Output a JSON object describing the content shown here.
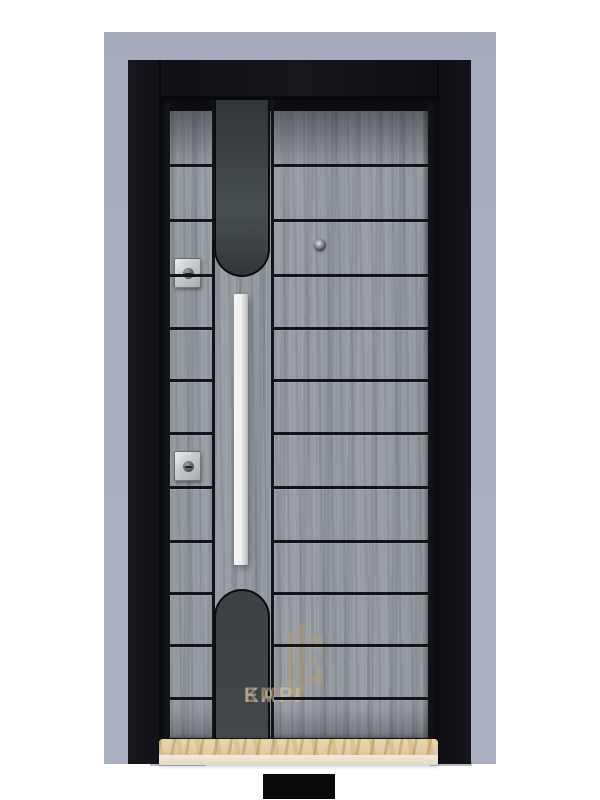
{
  "meta": {
    "description": "Product photo of a grey wood-grain steel security door with black frame, long white vertical pull handle, two cylinder locks, peephole and marble threshold"
  },
  "colors": {
    "background": "#ffffff",
    "wall": "#a8aebf",
    "frame": "#15161b",
    "wood": "#979da3",
    "groove": "#121419",
    "insert": "#3d4347",
    "insert_border": "#0b0c0f",
    "handle": "#ecedec",
    "steel": "#a8acaf",
    "marble": "#e6d3ae",
    "marble_front": "#f2ead7",
    "watermark_gold": "#c8a35b",
    "watermark_silver": "#ccd1d7",
    "shadow": "#7e838d",
    "footer_black": "#0a0a0a"
  },
  "watermark": {
    "word1": "EMİN",
    "word2": "KAPI"
  },
  "door": {
    "leaf_top": 100,
    "panel_lines_y": [
      165,
      220,
      275,
      328,
      380,
      433,
      487,
      541,
      593,
      645,
      698
    ],
    "columns": {
      "left": {
        "x": 0,
        "width": 42
      },
      "right": {
        "x": 104,
        "width": 154
      }
    }
  }
}
